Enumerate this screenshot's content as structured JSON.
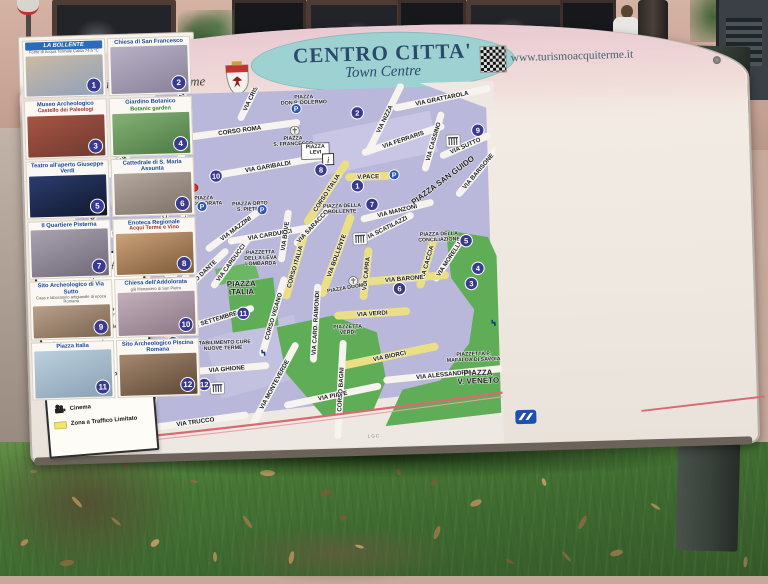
{
  "header": {
    "title": "CENTRO CITTA'",
    "subtitle": "Town Centre",
    "city": "Città di Acqui Terme",
    "website": "www.turismoacquiterme.it",
    "credit": "LGC"
  },
  "colors": {
    "block_lavender": "#b9b7da",
    "block_light": "#c8c6e4",
    "street_white": "#f7f3ef",
    "ztl_yellow": "#eadf85",
    "park_green": "#5fae57",
    "railway_red": "#d96a72",
    "marker_blue": "#3a3a8e",
    "parking_blue": "#2f55b4",
    "you_are_here_red": "#d93025",
    "title_teal": "#9ed2d2"
  },
  "legend": {
    "title": "LEGENDA",
    "items": [
      {
        "icon": "you-are-here-dot",
        "label": "Voi siete qui",
        "sub": "You are here",
        "italic": true,
        "indent": false
      },
      {
        "icon": "info-icon",
        "label": "I.A.T.",
        "sub": "Piazza Levi, 1",
        "italic": false,
        "indent": false
      },
      {
        "icon": "none",
        "label": "UFFICIO TURISMO",
        "sub": "COMUNE di Acqui Terme - Piazza Levi",
        "italic": false,
        "indent": true
      },
      {
        "icon": "museum-icon",
        "label": "Mostra Archeologica Estiva",
        "sub": "",
        "italic": false,
        "indent": false
      },
      {
        "icon": "spa-icon",
        "label": "Centro Termale",
        "sub": "",
        "italic": false,
        "indent": false
      },
      {
        "icon": "worship-icon",
        "label": "Luogo di Culto",
        "sub": "",
        "italic": false,
        "indent": false
      },
      {
        "icon": "ruins-icon",
        "label": "Sito Archeologico",
        "sub": "",
        "italic": false,
        "indent": false
      },
      {
        "icon": "theater-icon",
        "label": "Teatro",
        "sub": "",
        "italic": false,
        "indent": false
      },
      {
        "icon": "cinema-icon",
        "label": "Cinema",
        "sub": "",
        "italic": false,
        "indent": false
      },
      {
        "icon": "ztl-swatch",
        "label": "Zona a Traffico Limitato",
        "sub": "",
        "italic": false,
        "indent": false
      }
    ]
  },
  "map": {
    "capitolium": "CAPITOLIUM",
    "streets": [
      [
        "VIA M.FERRARIS",
        110,
        17,
        -55,
        55,
        "w"
      ],
      [
        "VIA CRISPI",
        188,
        8,
        -62,
        48,
        "w"
      ],
      [
        "CORSO ROMA",
        175,
        42,
        -6,
        115,
        "w"
      ],
      [
        "VIA GALEAZZO",
        70,
        57,
        -38,
        70,
        "w"
      ],
      [
        "VIA GALEAZZO",
        30,
        112,
        -72,
        62,
        "w"
      ],
      [
        "VIA MARCONI",
        78,
        80,
        -3,
        85,
        "w"
      ],
      [
        "CORSO CAVOUR",
        103,
        108,
        -73,
        105,
        "w"
      ],
      [
        "VIA DON BOSCO",
        42,
        142,
        -4,
        78,
        "w"
      ],
      [
        "VIA NIZZA",
        320,
        35,
        -62,
        72,
        "w"
      ],
      [
        "VIA GRATTAROLA",
        378,
        16,
        -10,
        92,
        "w"
      ],
      [
        "VIA FERRARIS",
        338,
        56,
        -17,
        80,
        "w"
      ],
      [
        "VIA CASSINO",
        368,
        59,
        -72,
        55,
        "w"
      ],
      [
        "VIA SUTTO",
        400,
        64,
        -22,
        48,
        "w"
      ],
      [
        "VIA BARISONE",
        412,
        90,
        -48,
        58,
        "w"
      ],
      [
        "VIA GARIBALDI",
        202,
        79,
        -8,
        112,
        "w"
      ],
      [
        "CORSO ITALIA",
        260,
        107,
        -55,
        68,
        "z"
      ],
      [
        "V.PACE",
        302,
        92,
        0,
        38,
        "z"
      ],
      [
        "VIA MANZONI",
        330,
        127,
        -12,
        68,
        "w"
      ],
      [
        "VIA SCATILAZZI",
        318,
        144,
        -25,
        55,
        "w"
      ],
      [
        "VIA SARACCO",
        245,
        140,
        -45,
        45,
        "w"
      ],
      [
        "VIA BOLLENTE",
        268,
        170,
        -68,
        80,
        "z"
      ],
      [
        "VIA CACCIA",
        358,
        180,
        -72,
        45,
        "z"
      ],
      [
        "VIA MORELLI",
        380,
        177,
        -55,
        45,
        "w"
      ],
      [
        "VIA CAPRA",
        297,
        189,
        -82,
        45,
        "z"
      ],
      [
        "VIA BARONE",
        335,
        195,
        -3,
        82,
        "z"
      ],
      [
        "VIA VERDI",
        302,
        229,
        -2,
        68,
        "z"
      ],
      [
        "VIA BIORCI",
        318,
        272,
        -10,
        92,
        "z"
      ],
      [
        "VIA ALESSANDRIA",
        372,
        292,
        -4,
        115,
        "w"
      ],
      [
        "VIA PIAVE",
        260,
        310,
        -10,
        92,
        "w"
      ],
      [
        "VIA TRUCCO",
        122,
        332,
        -6,
        100,
        "w"
      ],
      [
        "CORSO BAGNI",
        268,
        304,
        -85,
        92,
        "w"
      ],
      [
        "VIA MONTEVERDE",
        202,
        297,
        -60,
        88,
        "w"
      ],
      [
        "VIA GHIONE",
        155,
        280,
        -3,
        78,
        "w"
      ],
      [
        "VIA BARETTI",
        82,
        302,
        -78,
        62,
        "w"
      ],
      [
        "VIA XX SETTEMBRE",
        138,
        232,
        -15,
        88,
        "w"
      ],
      [
        "CORSO DANTE",
        130,
        187,
        -42,
        72,
        "w"
      ],
      [
        "VIA OTTOLENGHI",
        98,
        214,
        -55,
        66,
        "w"
      ],
      [
        "VIA BATTISTI",
        76,
        190,
        -68,
        42,
        "w"
      ],
      [
        "VIA CARDUCCI",
        202,
        147,
        -8,
        78,
        "w"
      ],
      [
        "VIA CARDUCCI",
        162,
        174,
        -52,
        55,
        "w"
      ],
      [
        "VIA MAZZINI",
        168,
        140,
        -35,
        66,
        "w"
      ],
      [
        "VIA TOGLIATTI",
        116,
        132,
        -82,
        46,
        "w"
      ],
      [
        "VIA BOVE",
        217,
        149,
        -80,
        46,
        "w"
      ],
      [
        "CORSO ITALIA",
        226,
        180,
        -72,
        60,
        "z"
      ],
      [
        "CORSO VIGANO",
        203,
        229,
        -72,
        76,
        "w"
      ],
      [
        "VIA CARD. RAIMONDI",
        245,
        237,
        -85,
        72,
        "w"
      ]
    ],
    "places": [
      {
        "l": [
          "PIAZZA",
          "DON P. DOLERMO"
        ],
        "x": 240,
        "y": 12,
        "r": 0,
        "box": false,
        "big": false
      },
      {
        "l": [
          "PIAZZA",
          "S. FRANCESCO"
        ],
        "x": 228,
        "y": 53,
        "r": 0,
        "box": false,
        "big": false
      },
      {
        "l": [
          "PIAZZA",
          "LEVI"
        ],
        "x": 250,
        "y": 62,
        "r": 0,
        "box": true,
        "big": false
      },
      {
        "l": [
          "PIAZZA",
          "ADDOLORATA"
        ],
        "x": 137,
        "y": 110,
        "r": 0,
        "box": false,
        "big": false
      },
      {
        "l": [
          "PIAZZA ORTO",
          "S. PIETRO"
        ],
        "x": 183,
        "y": 117,
        "r": 0,
        "box": false,
        "big": false
      },
      {
        "l": [
          "PIAZZA DELLA",
          "BOLLENTE"
        ],
        "x": 275,
        "y": 122,
        "r": 0,
        "box": false,
        "big": false
      },
      {
        "l": [
          "PIAZZA DELLA",
          "CONCILIAZIONE"
        ],
        "x": 371,
        "y": 153,
        "r": 0,
        "box": false,
        "big": false
      },
      {
        "l": [
          "PIAZZA SAN GUIDO"
        ],
        "x": 378,
        "y": 100,
        "r": -35,
        "box": false,
        "big": true
      },
      {
        "l": [
          "PIAZZA DUOMO"
        ],
        "x": 278,
        "y": 204,
        "r": -8,
        "box": false,
        "big": false
      },
      {
        "l": [
          "PIAZZETTA",
          "VERDI"
        ],
        "x": 277,
        "y": 243,
        "r": 0,
        "box": false,
        "big": false
      },
      {
        "l": [
          "PIAZZA",
          "ITALIA"
        ],
        "x": 172,
        "y": 198,
        "r": 0,
        "box": false,
        "big": true
      },
      {
        "l": [
          "PIAZZA",
          "MATTEOTTI"
        ],
        "x": 70,
        "y": 242,
        "r": -80,
        "box": false,
        "big": false
      },
      {
        "l": [
          "PIAZZETTA",
          "DELLA LEVA",
          "LOMBARDA"
        ],
        "x": 192,
        "y": 166,
        "r": 0,
        "box": false,
        "big": false
      },
      {
        "l": [
          "STABILIMENTO CURE",
          "NUOVE TERME"
        ],
        "x": 152,
        "y": 255,
        "r": 0,
        "box": false,
        "big": false
      },
      {
        "l": [
          "PIAZZETTA P.",
          "MAFALDA DI SAVOIA"
        ],
        "x": 402,
        "y": 274,
        "r": 0,
        "box": false,
        "big": false
      },
      {
        "l": [
          "PIAZZA",
          "V. VENETO"
        ],
        "x": 406,
        "y": 294,
        "r": 0,
        "box": false,
        "big": true
      }
    ],
    "markers": [
      [
        1,
        291,
        101
      ],
      [
        2,
        293,
        28
      ],
      [
        3,
        402,
        202
      ],
      [
        4,
        409,
        187
      ],
      [
        5,
        398,
        159
      ],
      [
        6,
        330,
        205
      ],
      [
        7,
        305,
        120
      ],
      [
        8,
        255,
        84
      ],
      [
        9,
        413,
        49
      ],
      [
        10,
        150,
        87
      ],
      [
        11,
        173,
        225
      ],
      [
        12,
        132,
        295
      ]
    ],
    "parking": [
      [
        232,
        22
      ],
      [
        328,
        91
      ],
      [
        135,
        117
      ],
      [
        195,
        122
      ]
    ],
    "you_are_here": {
      "x": 126,
      "y": 98
    },
    "info_box": {
      "x": 262,
      "y": 74
    },
    "capitolium_pos": {
      "x": 88,
      "y": 60
    },
    "icons": [
      [
        "ruins",
        388,
        59
      ],
      [
        "ruins",
        145,
        299
      ],
      [
        "masks",
        102,
        181
      ],
      [
        "ruins",
        292,
        154
      ],
      [
        "cinema",
        80,
        267
      ],
      [
        "spa",
        102,
        252
      ],
      [
        "tap",
        193,
        264
      ],
      [
        "tap",
        424,
        241
      ],
      [
        "church",
        230,
        44
      ],
      [
        "church",
        284,
        196
      ]
    ]
  },
  "sidebar": {
    "items": [
      {
        "num": "1",
        "name": "LA BOLLENTE",
        "style": "banner",
        "sub": "Fonte di Acqua Termale Calda 74,5 °C",
        "sub_style": "",
        "photo": [
          "#cbbaa3",
          "#8fa0bb"
        ]
      },
      {
        "num": "2",
        "name": "Chiesa di San Francesco",
        "style": "",
        "sub": "",
        "sub_style": "",
        "photo": [
          "#b9b1c6",
          "#878198"
        ]
      },
      {
        "num": "3",
        "name": "Museo Archeologico",
        "style": "",
        "sub": "Castello dei Paleologi",
        "sub_style": "red",
        "photo": [
          "#a85444",
          "#6e3a30"
        ]
      },
      {
        "num": "4",
        "name": "Giardino Botanico",
        "style": "",
        "sub": "Botanic garden",
        "sub_style": "green",
        "photo": [
          "#84b172",
          "#4c7a46"
        ]
      },
      {
        "num": "5",
        "name": "Teatro all'aperto Giuseppe Verdi",
        "style": "",
        "sub": "",
        "sub_style": "",
        "photo": [
          "#2c3c6e",
          "#10182e"
        ]
      },
      {
        "num": "6",
        "name": "Cattedrale di S. Maria Assunta",
        "style": "",
        "sub": "",
        "sub_style": "",
        "photo": [
          "#b5a89e",
          "#7d7066"
        ]
      },
      {
        "num": "7",
        "name": "Il Quartiere Pisterna",
        "style": "",
        "sub": "",
        "sub_style": "",
        "photo": [
          "#a9a2b0",
          "#6f6878"
        ]
      },
      {
        "num": "8",
        "name": "Enoteca Regionale",
        "style": "",
        "sub": "Acqui Terme e Vino",
        "sub_style": "red",
        "photo": [
          "#caa27a",
          "#7e5a3a"
        ]
      },
      {
        "num": "9",
        "name": "Sito Archeologico di Via Sutto",
        "style": "",
        "sub": "Casa e laboratorio artigianale di epoca Romana",
        "sub_style": "",
        "photo": [
          "#b9a08a",
          "#7a6450"
        ]
      },
      {
        "num": "10",
        "name": "Chiesa dell'Addolorata",
        "style": "",
        "sub": "già Monastero di San Pietro",
        "sub_style": "",
        "photo": [
          "#c4afbc",
          "#8a7584"
        ]
      },
      {
        "num": "11",
        "name": "Piazza Italia",
        "style": "",
        "sub": "",
        "sub_style": "",
        "photo": [
          "#bcd0dc",
          "#8aa0b4"
        ]
      },
      {
        "num": "12",
        "name": "Sito Archeologico Piscina Romana",
        "style": "",
        "sub": "",
        "sub_style": "",
        "photo": [
          "#a5886e",
          "#5d4836"
        ]
      }
    ]
  }
}
